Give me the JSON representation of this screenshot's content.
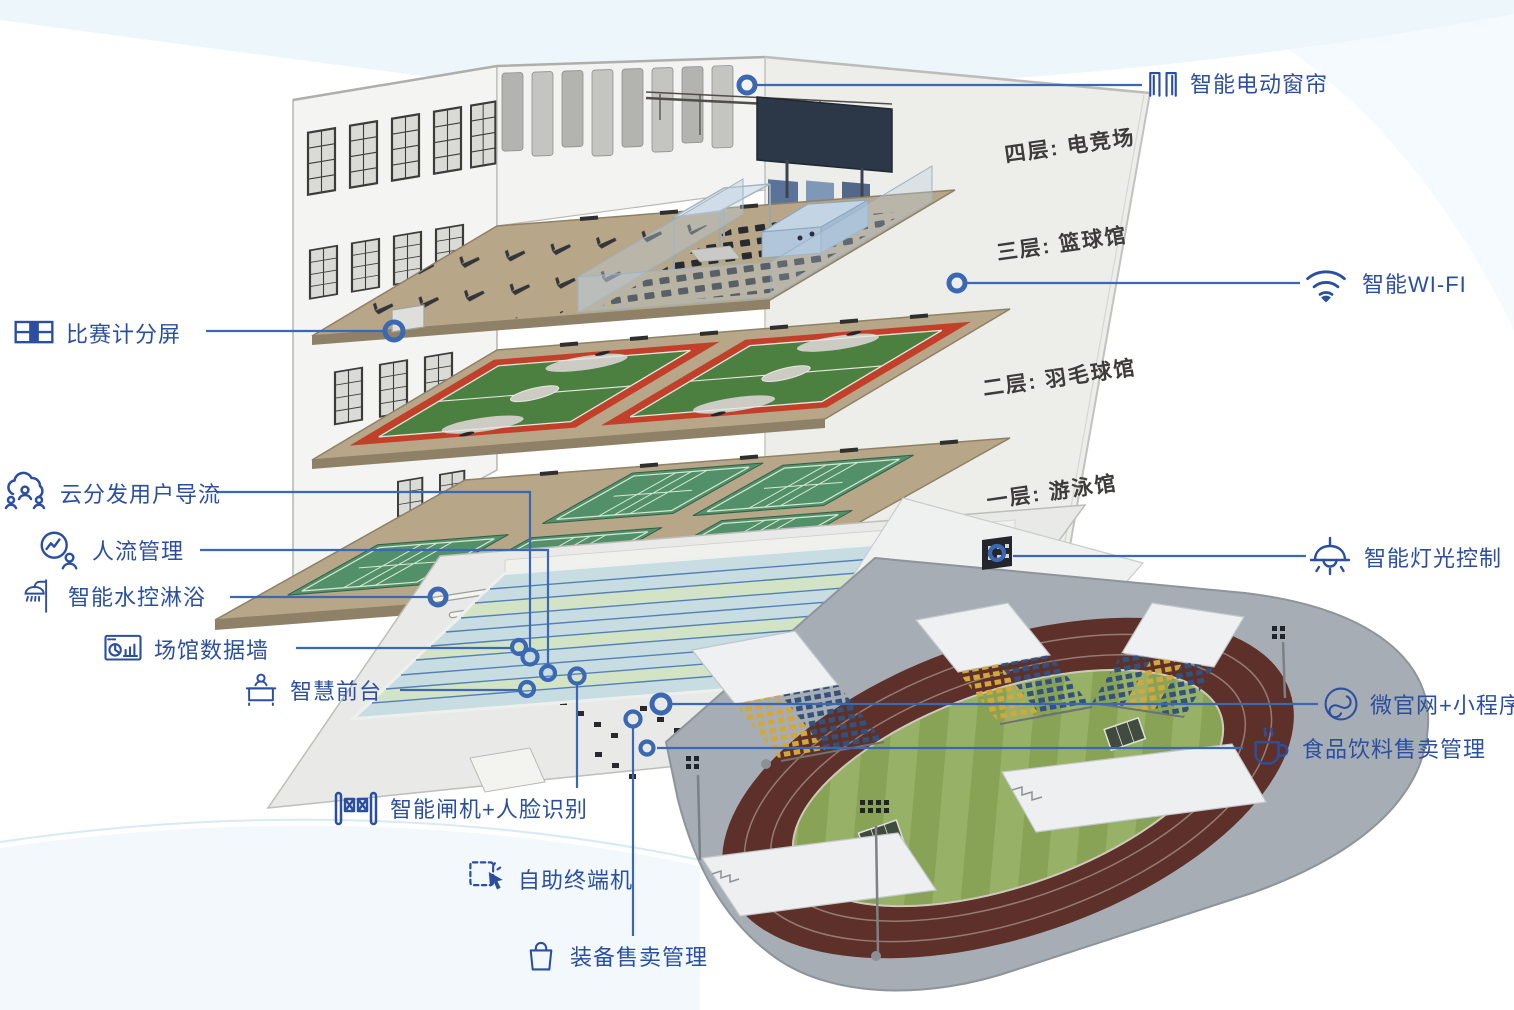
{
  "colors": {
    "accent": "#2b4fa0",
    "leader_line": "#3a68b2",
    "floor_label": "#3d3c3a",
    "wall": "#f4f4f2",
    "slab_tan": "#b7a688",
    "court_red": "#c2402a",
    "court_green": "#4c8040",
    "badminton_green": "#52906a",
    "pool_blue": "#c2d9de",
    "track_maroon": "#5d3029",
    "field_green": "#92ac60",
    "platform_gray": "#a6adb4",
    "seat_yellow": "#d2a73c",
    "seat_blue": "#33517b"
  },
  "floor_labels": [
    {
      "id": "floor-4",
      "label": "四层: 电竞场"
    },
    {
      "id": "floor-3",
      "label": "三层: 篮球馆"
    },
    {
      "id": "floor-2",
      "label": "二层: 羽毛球馆"
    },
    {
      "id": "floor-1",
      "label": "一层: 游泳馆"
    }
  ],
  "callouts": [
    {
      "id": "smart-curtain",
      "label": "智能电动窗帘",
      "icon": "curtain-icon"
    },
    {
      "id": "smart-wifi",
      "label": "智能WI-FI",
      "icon": "wifi-icon"
    },
    {
      "id": "smart-lighting",
      "label": "智能灯光控制",
      "icon": "pendant-lamp-icon"
    },
    {
      "id": "micro-site-mini-program",
      "label": "微官网+小程序",
      "icon": "mini-program-icon"
    },
    {
      "id": "food-beverage-sales",
      "label": "食品饮料售卖管理",
      "icon": "beverage-cup-icon"
    },
    {
      "id": "match-scoreboard",
      "label": "比赛计分屏",
      "icon": "scoreboard-icon"
    },
    {
      "id": "cloud-user-distribution",
      "label": "云分发用户导流",
      "icon": "cloud-users-icon"
    },
    {
      "id": "crowd-management",
      "label": "人流管理",
      "icon": "people-flow-icon"
    },
    {
      "id": "smart-shower",
      "label": "智能水控淋浴",
      "icon": "shower-icon"
    },
    {
      "id": "venue-data-wall",
      "label": "场馆数据墙",
      "icon": "data-wall-icon"
    },
    {
      "id": "smart-front-desk",
      "label": "智慧前台",
      "icon": "front-desk-icon"
    },
    {
      "id": "smart-gate-face-recognition",
      "label": "智能闸机+人脸识别",
      "icon": "turnstile-icon"
    },
    {
      "id": "self-service-kiosk",
      "label": "自助终端机",
      "icon": "touch-kiosk-icon"
    },
    {
      "id": "equipment-sales",
      "label": "装备售卖管理",
      "icon": "shopping-bag-icon"
    }
  ]
}
